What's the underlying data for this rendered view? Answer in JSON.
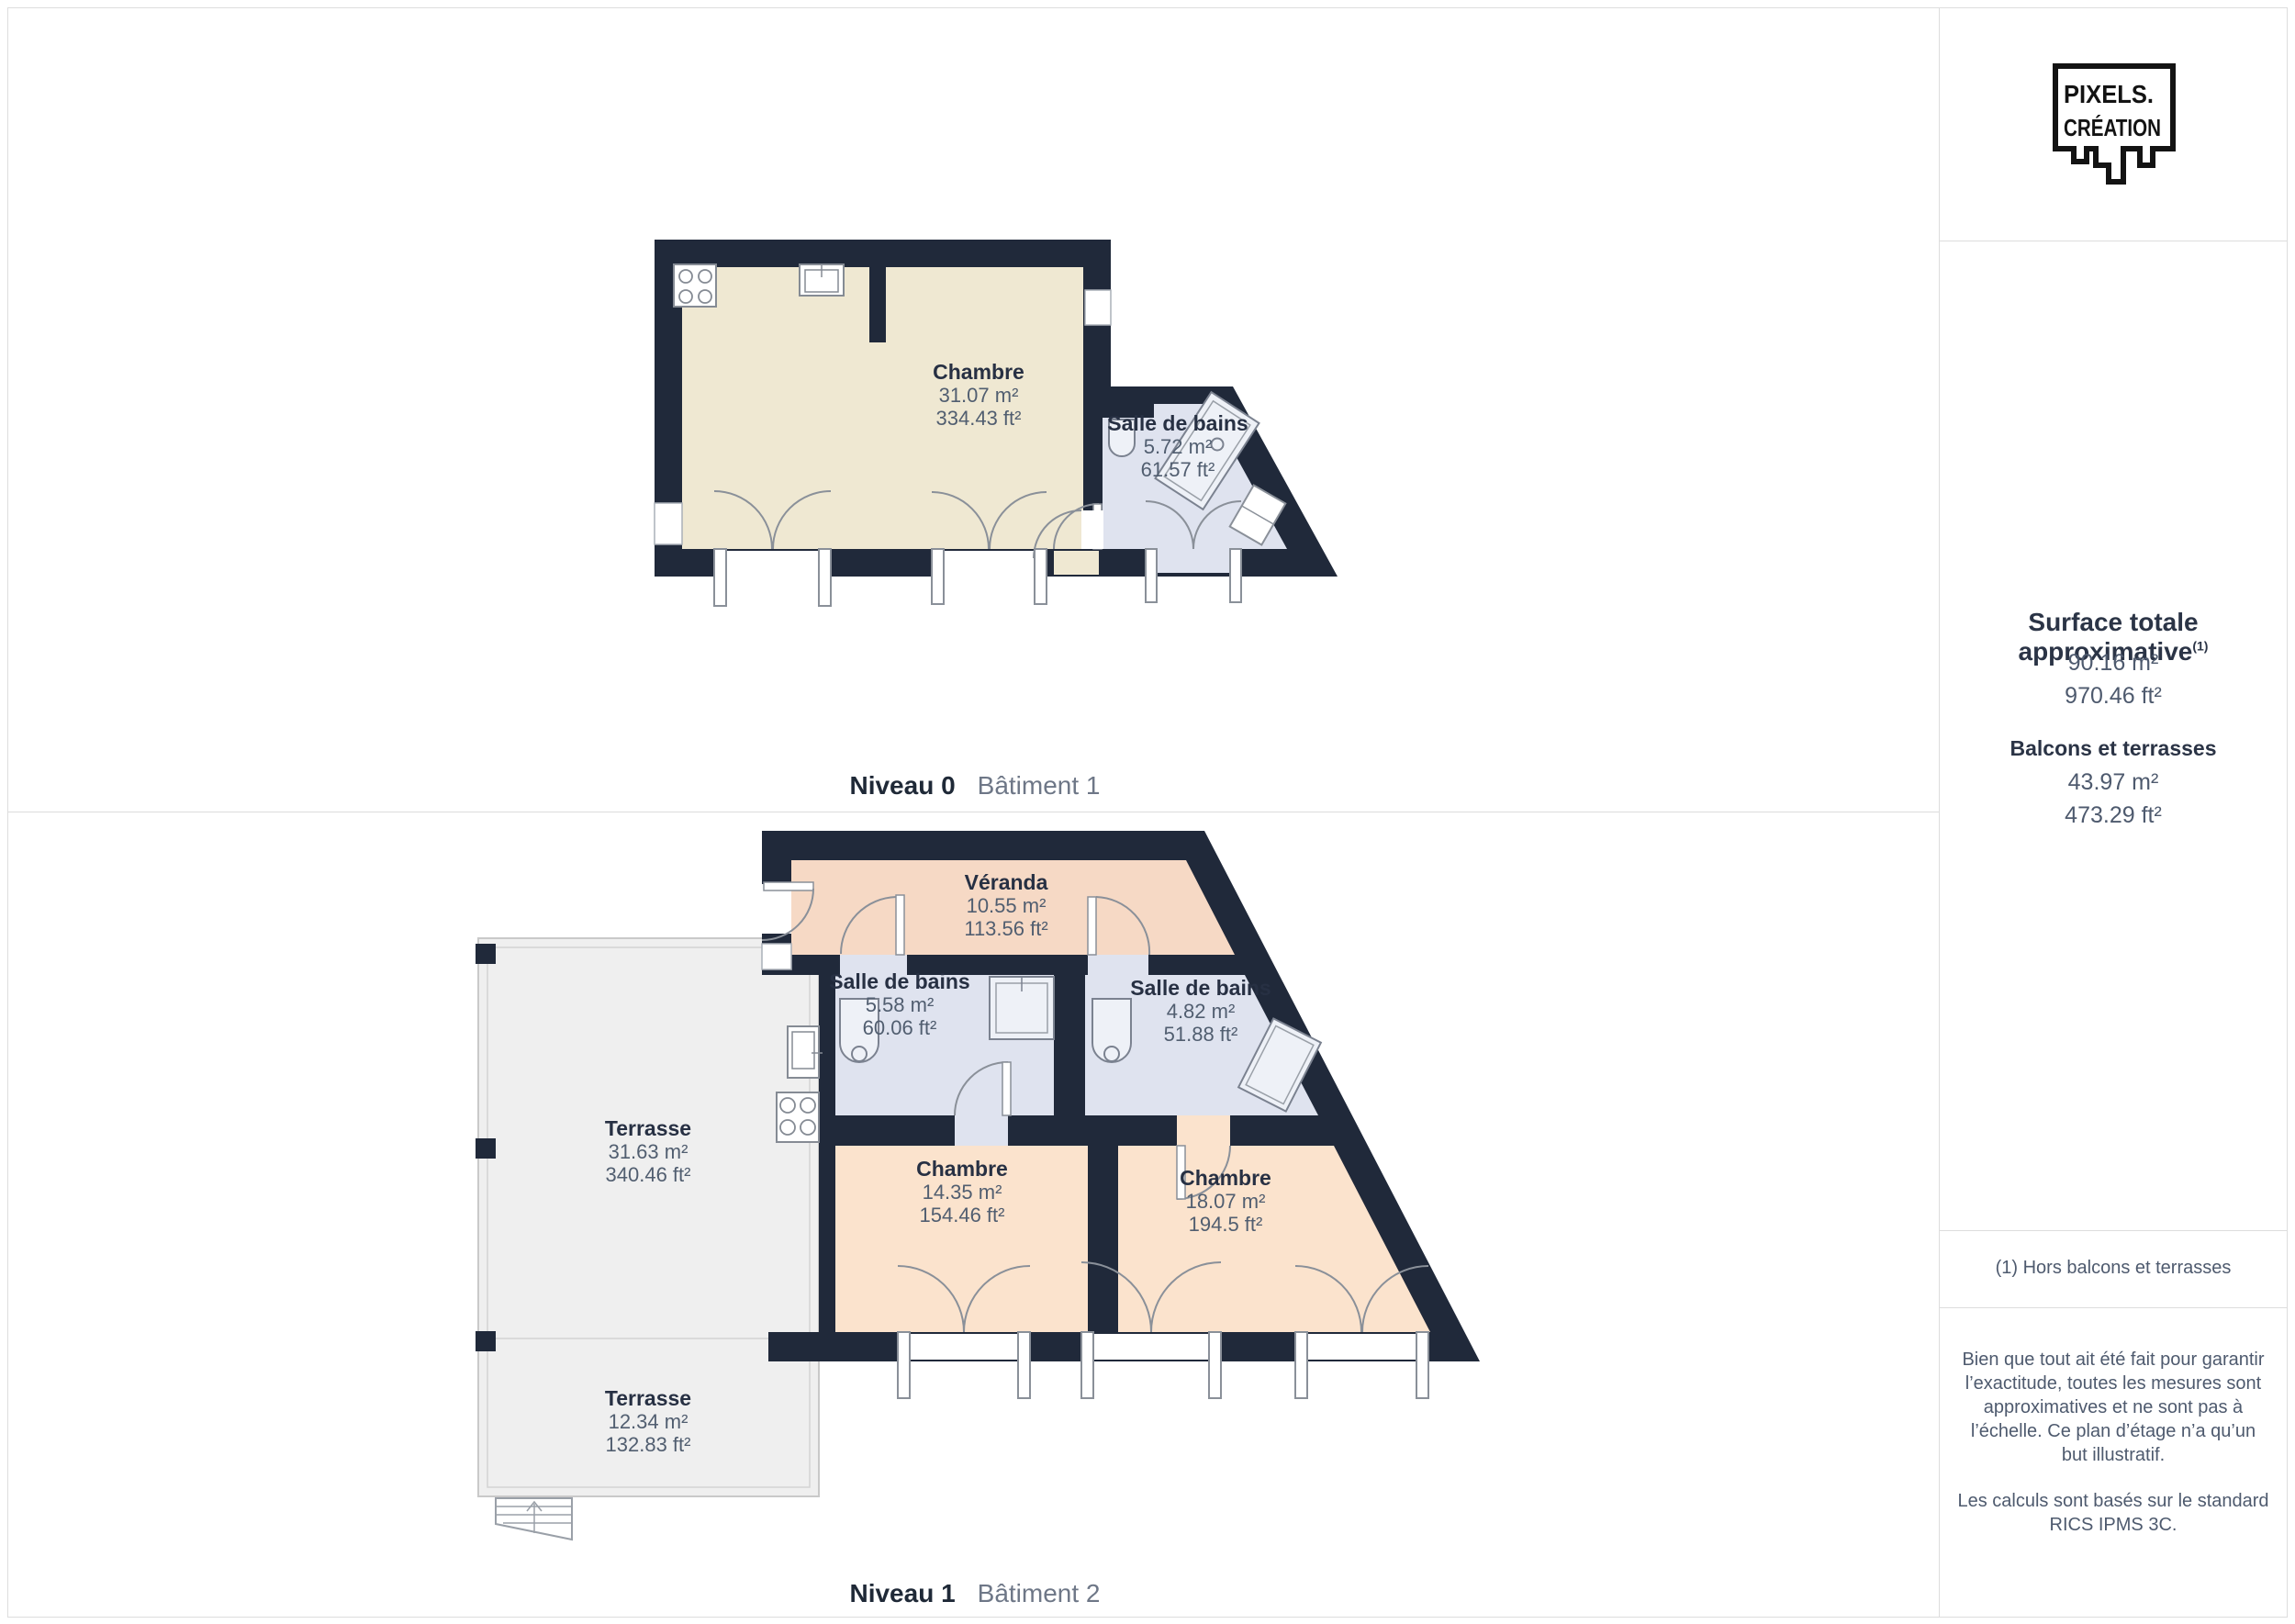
{
  "logo": {
    "line1": "PIXELS.",
    "line2": "CRÉATION"
  },
  "sidebar": {
    "title": "Surface totale approximative",
    "title_marker": "(1)",
    "total_m2": "90.16 m²",
    "total_ft2": "970.46 ft²",
    "balconies_heading": "Balcons et terrasses",
    "balconies_m2": "43.97 m²",
    "balconies_ft2": "473.29 ft²",
    "footnote": "(1) Hors balcons et terrasses",
    "disclaimer1": "Bien que tout ait été fait pour garantir l’exactitude, toutes les mesures sont approximatives et ne sont pas à l’échelle. Ce plan d’étage n’a qu’un but illustratif.",
    "disclaimer2": "Les calculs sont basés sur le standard RICS IPMS 3C."
  },
  "levels": [
    {
      "name": "Niveau 0",
      "building": "Bâtiment 1",
      "rooms": [
        {
          "name": "Chambre",
          "m2": "31.07 m²",
          "ft2": "334.43 ft²"
        },
        {
          "name": "Salle de bains",
          "m2": "5.72 m²",
          "ft2": "61.57 ft²"
        }
      ]
    },
    {
      "name": "Niveau 1",
      "building": "Bâtiment 2",
      "rooms": [
        {
          "name": "Véranda",
          "m2": "10.55 m²",
          "ft2": "113.56 ft²"
        },
        {
          "name": "Salle de bains",
          "m2": "5.58 m²",
          "ft2": "60.06 ft²"
        },
        {
          "name": "Salle de bains",
          "m2": "4.82 m²",
          "ft2": "51.88 ft²"
        },
        {
          "name": "Terrasse",
          "m2": "31.63 m²",
          "ft2": "340.46 ft²"
        },
        {
          "name": "Chambre",
          "m2": "14.35 m²",
          "ft2": "154.46 ft²"
        },
        {
          "name": "Chambre",
          "m2": "18.07 m²",
          "ft2": "194.5 ft²"
        },
        {
          "name": "Terrasse",
          "m2": "12.34 m²",
          "ft2": "132.83 ft²"
        }
      ]
    }
  ],
  "colors": {
    "wall": "#20293a",
    "room_cream": "#efe8d2",
    "room_peach": "#fbe3cd",
    "veranda_salmon": "#f6d9c5",
    "bathroom_blue": "#dfe3ef",
    "terrace_grey": "#efefef",
    "divider_grey": "#dddddd",
    "text_dark": "#273043",
    "text_grey": "#4e5a6e"
  }
}
